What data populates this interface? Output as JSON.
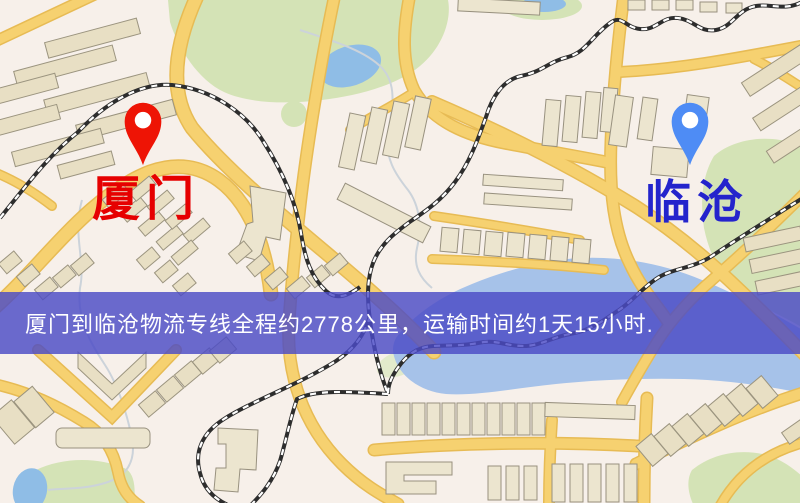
{
  "map": {
    "pins": {
      "origin": {
        "label": "厦门",
        "pin_color": "#ee1405",
        "label_color": "#e60000"
      },
      "destination": {
        "label": "临沧",
        "pin_color": "#4e8cf5",
        "label_color": "#2424cc"
      }
    }
  },
  "banner": {
    "text": "厦门到临沧物流专线全程约2778公里，运输时间约1天15小时.",
    "distance_km": "2778",
    "duration": "1天15小时",
    "background": "rgba(74,74,198,0.82)",
    "text_color": "#ffffff"
  },
  "palette": {
    "map_background": "#f7f0ea",
    "road": "#f6d170",
    "railway": "#2d2d2d",
    "park": "#d4e3b6",
    "water": "#a6c2e9",
    "building": "#e8dfc4"
  }
}
